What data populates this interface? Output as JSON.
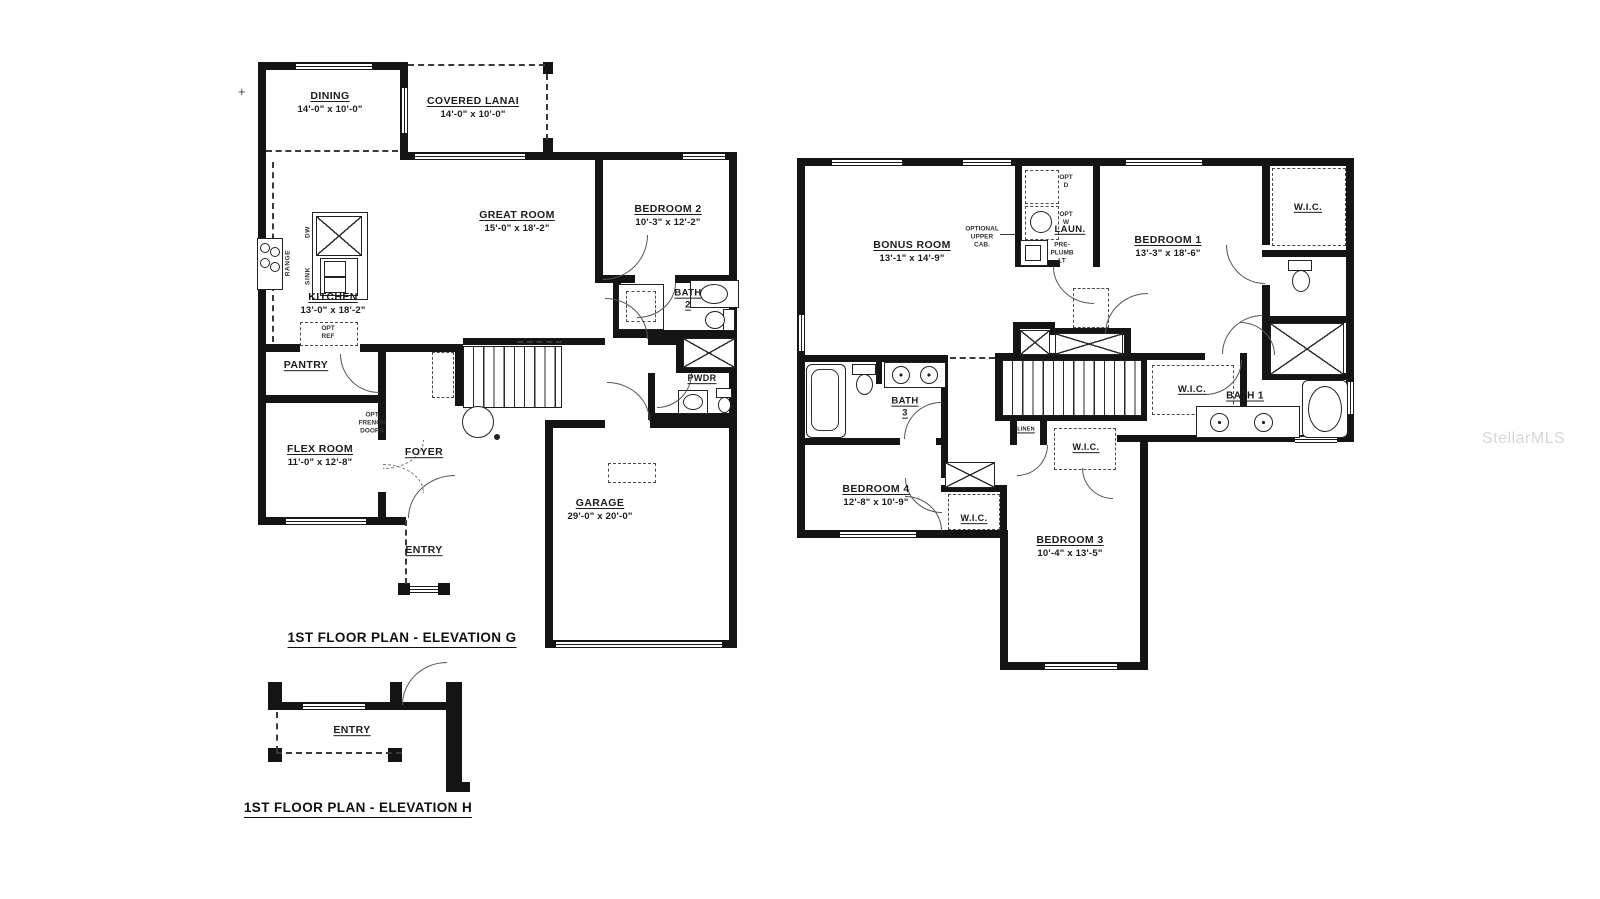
{
  "mark": "+",
  "watermark": "StellarMLS",
  "g": {
    "caption": "1ST FLOOR PLAN - ELEVATION G",
    "rooms": {
      "dining": {
        "name": "DINING",
        "dims": "14'-0\" x 10'-0\""
      },
      "lanai": {
        "name": "COVERED LANAI",
        "dims": "14'-0\" x 10'-0\""
      },
      "great": {
        "name": "GREAT ROOM",
        "dims": "15'-0\" x 18'-2\""
      },
      "kitchen": {
        "name": "KITCHEN",
        "dims": "13'-0\" x 18'-2\""
      },
      "bed2": {
        "name": "BEDROOM 2",
        "dims": "10'-3\" x 12'-2\""
      },
      "bath2": {
        "name": "BATH",
        "num": "2"
      },
      "pwdr": {
        "name": "PWDR"
      },
      "pantry": {
        "name": "PANTRY"
      },
      "flex": {
        "name": "FLEX ROOM",
        "dims": "11'-0\" x 12'-8\""
      },
      "foyer": {
        "name": "FOYER"
      },
      "entry": {
        "name": "ENTRY"
      },
      "garage": {
        "name": "GARAGE",
        "dims": "29'-0\" x 20'-0\""
      }
    },
    "notes": {
      "range": "RANGE",
      "dw": "DW",
      "sink": "SINK",
      "optref": "OPT\nREF",
      "optfrench": "OPT\nFRENCH\nDOORS"
    }
  },
  "h": {
    "caption": "1ST FLOOR PLAN - ELEVATION H",
    "rooms": {
      "entry": {
        "name": "ENTRY"
      }
    }
  },
  "u": {
    "rooms": {
      "bonus": {
        "name": "BONUS ROOM",
        "dims": "13'-1\" x 14'-9\""
      },
      "laun": {
        "name": "LAUN."
      },
      "bed1": {
        "name": "BEDROOM 1",
        "dims": "13'-3\" x 18'-6\""
      },
      "wic1": {
        "name": "W.I.C."
      },
      "bath1": {
        "name": "BATH 1"
      },
      "wic2": {
        "name": "W.I.C."
      },
      "bath3": {
        "name": "BATH",
        "num": "3"
      },
      "bed4": {
        "name": "BEDROOM 4",
        "dims": "12'-8\" x 10'-9\""
      },
      "wic4": {
        "name": "W.I.C."
      },
      "linen": {
        "name": "LINEN"
      },
      "wic3": {
        "name": "W.I.C."
      },
      "bed3": {
        "name": "BEDROOM 3",
        "dims": "10'-4\" x 13'-5\""
      }
    },
    "notes": {
      "optd": "OPT\nD",
      "optw": "OPT\nW",
      "preplumb": "PRE-\nPLUMB\nLT",
      "optcab": "OPTIONAL\nUPPER\nCAB."
    }
  }
}
